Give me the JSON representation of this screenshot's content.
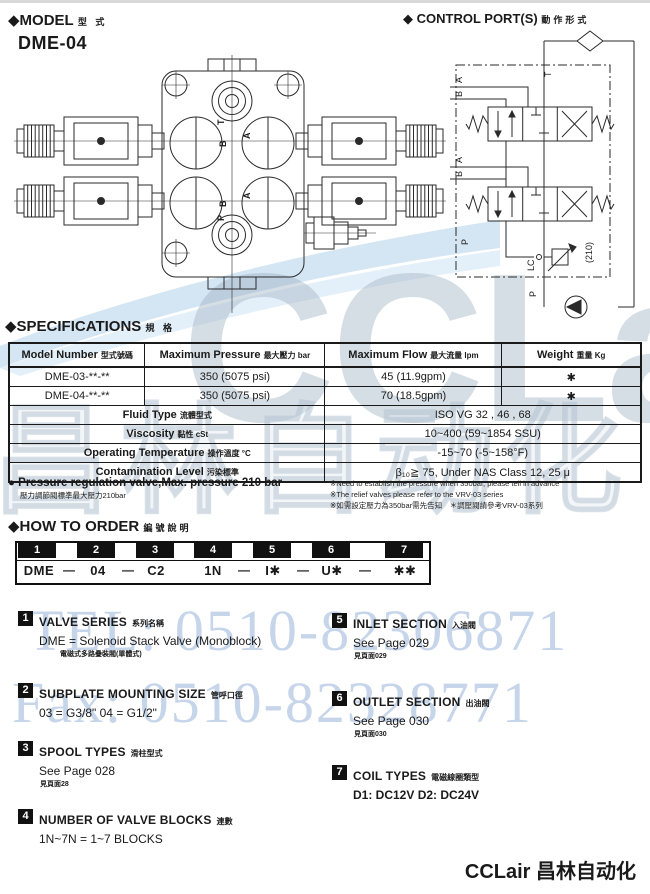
{
  "icons": {
    "diamond": "◆",
    "bullet": "●"
  },
  "header": {
    "model_title": "MODEL",
    "model_title_cn": "型  式",
    "model_name": "DME-04",
    "control_title": "CONTROL PORT(S)",
    "control_title_cn": "動作形式"
  },
  "drawing": {
    "labels": {
      "t": "T",
      "b_top": "B",
      "a_top": "A",
      "b_bot": "B",
      "a_bot": "A",
      "p": "P"
    }
  },
  "schematic": {
    "labels": {
      "t": "T",
      "a1": "A",
      "b1": "B",
      "a2": "A",
      "b2": "B",
      "p_side": "P",
      "lc": "LC",
      "pressure": "(210)",
      "p_bottom": "P"
    }
  },
  "specifications": {
    "title": "SPECIFICATIONS",
    "title_cn": "規  格",
    "headers": [
      {
        "en": "Model Number",
        "cn": "型式號碼"
      },
      {
        "en": "Maximum Pressure",
        "cn": "最大壓力 bar"
      },
      {
        "en": "Maximum Flow",
        "cn": "最大流量 lpm"
      },
      {
        "en": "Weight",
        "cn": "重量 Kg"
      }
    ],
    "model_rows": [
      {
        "model": "DME-03-**-**",
        "pressure": "350 (5075 psi)",
        "flow": "45 (11.9gpm)",
        "weight": "✱"
      },
      {
        "model": "DME-04-**-**",
        "pressure": "350 (5075 psi)",
        "flow": "70 (18.5gpm)",
        "weight": "✱"
      }
    ],
    "property_rows": [
      {
        "label_en": "Fluid Type",
        "label_cn": "流體型式",
        "value": "ISO VG 32 , 46 , 68"
      },
      {
        "label_en": "Viscosity",
        "label_cn": "黏性  cSt",
        "value": "10~400 (59~1854 SSU)"
      },
      {
        "label_en": "Operating Temperature",
        "label_cn": "操作溫度 °C",
        "value": "-15~70 (-5~158°F)"
      },
      {
        "label_en": "Contamination Level",
        "label_cn": "污染標準",
        "value": "β₁₀≧ 75, Under NAS Class 12, 25 μ"
      }
    ],
    "note_bullet_en": "Pressure regulation valve,Max. pressure 210 bar",
    "note_bullet_cn": "壓力調節閥標準最大壓力210bar",
    "note_right_1": "※Need to establish the pressure when 350bar, please tell in advance",
    "note_right_2": "※The relief valves please refer to the VRV-03 series",
    "note_right_3": "※如需設定壓力為350bar需先告知　＊調壓閥請參考VRV-03系列"
  },
  "how_to_order": {
    "title": "HOW TO  ORDER",
    "title_cn": "編號說明",
    "positions": [
      "1",
      "2",
      "3",
      "4",
      "5",
      "6",
      "7"
    ],
    "code_segments": [
      "DME",
      "04",
      "C2",
      "1N",
      "I✱",
      "U✱",
      "✱✱"
    ],
    "dashes": [
      "—",
      "—",
      "",
      "—",
      "—",
      "—"
    ]
  },
  "order_sections": [
    {
      "num": "1",
      "title": "VALVE SERIES",
      "title_cn": "系列名稱",
      "line": "DME =  Solenoid Stack Valve (Monoblock)",
      "sub": "電磁式多路疊裝閥(單體式)"
    },
    {
      "num": "2",
      "title": "SUBPLATE MOUNTING SIZE",
      "title_cn": "管呼口徑",
      "line": "03 = G3/8\"   04 = G1/2\"",
      "sub": ""
    },
    {
      "num": "3",
      "title": "SPOOL TYPES",
      "title_cn": "滑柱型式",
      "line": "See  Page 028",
      "sub": "見頁面28"
    },
    {
      "num": "4",
      "title": "NUMBER OF VALVE BLOCKS",
      "title_cn": "連數",
      "line": "1N~7N =  1~7  BLOCKS",
      "sub": ""
    },
    {
      "num": "5",
      "title": "INLET SECTION",
      "title_cn": "入油閥",
      "line": "See Page 029",
      "sub": "見頁面029"
    },
    {
      "num": "6",
      "title": "OUTLET SECTION",
      "title_cn": "出油閥",
      "line": "See Page 030",
      "sub": "見頁面030"
    },
    {
      "num": "7",
      "title": "COIL TYPES",
      "title_cn": "電磁線圈類型",
      "line": "D1: DC12V    D2: DC24V",
      "sub": ""
    }
  ],
  "watermark": {
    "logo": "CCLair",
    "tel": "TEL: 0510-82306871",
    "fax": "Fax: 0510-82328771",
    "cn_outline": "昌林自动化",
    "accent_blue": "#b9d3ea"
  },
  "footer": {
    "brand": "CCLair 昌林自动化"
  }
}
